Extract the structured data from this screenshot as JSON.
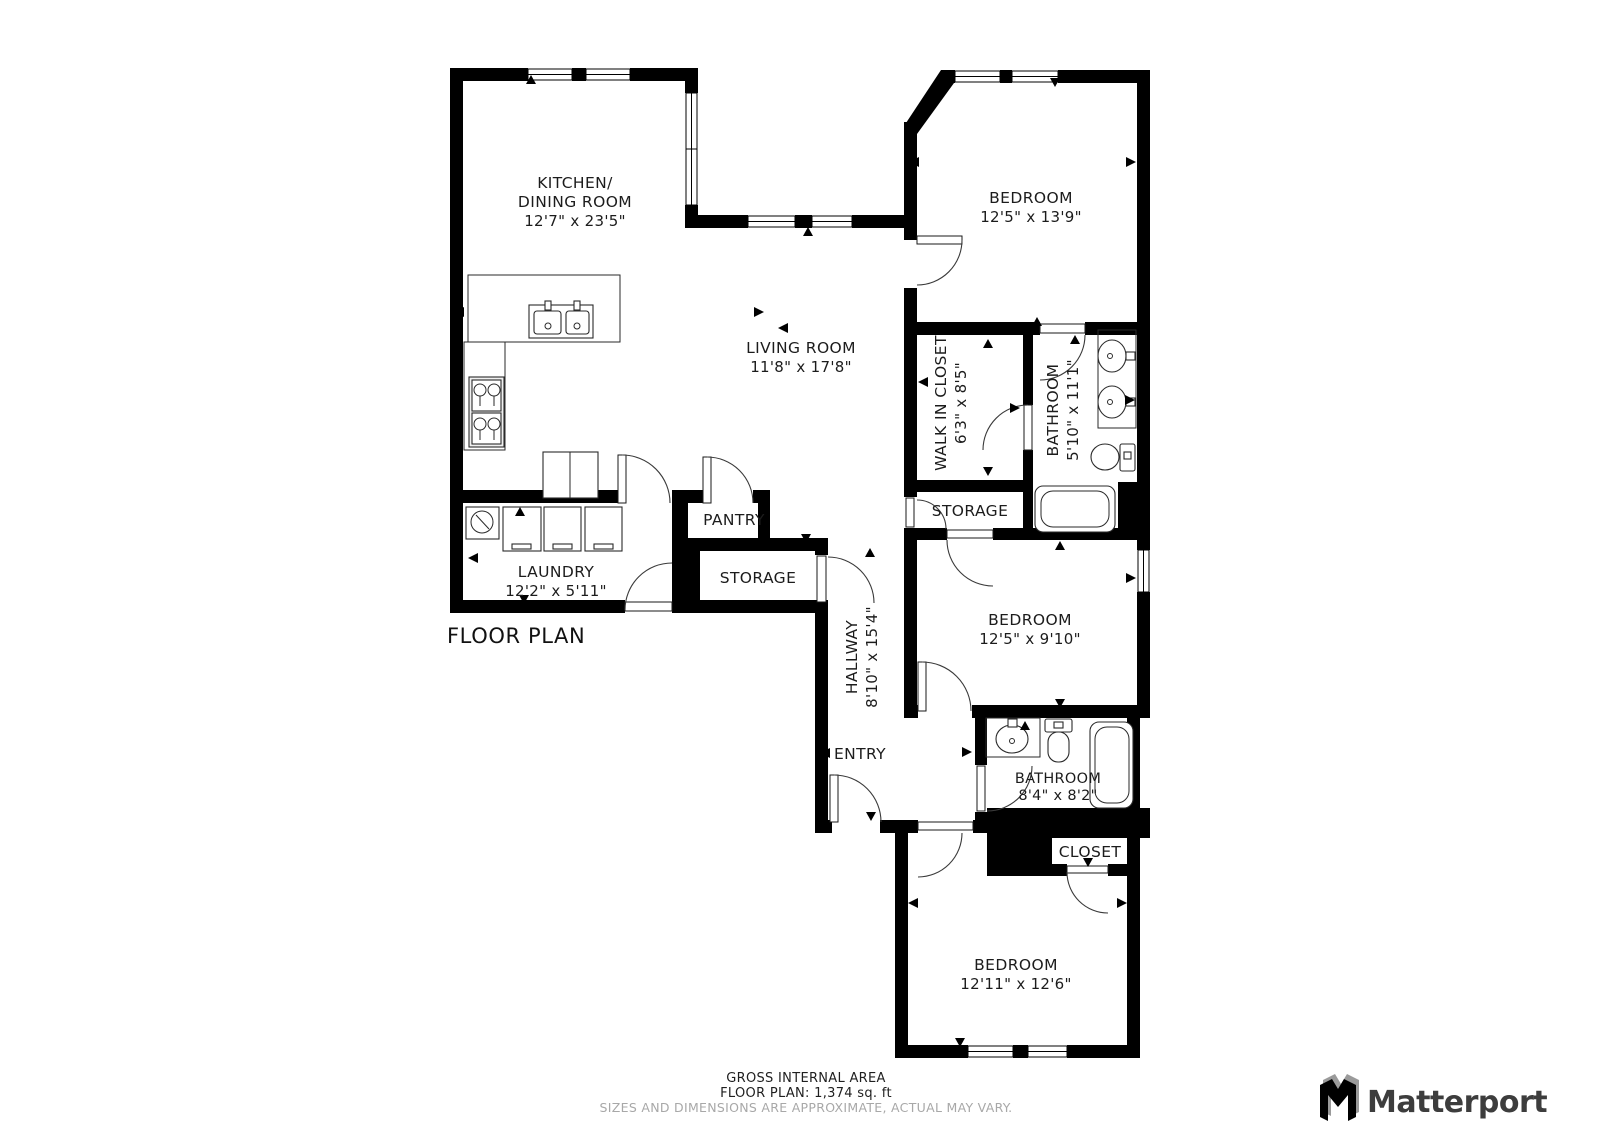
{
  "title": "FLOOR PLAN",
  "rooms": {
    "kitchen": {
      "line1": "KITCHEN/",
      "line2": "DINING ROOM",
      "dims": "12'7\" x 23'5\""
    },
    "living": {
      "name": "LIVING ROOM",
      "dims": "11'8\" x 17'8\""
    },
    "bedroom1": {
      "name": "BEDROOM",
      "dims": "12'5\" x 13'9\""
    },
    "walk_in_closet": {
      "name": "WALK IN CLOSET",
      "dims": "6'3\" x 8'5\""
    },
    "bathroom1": {
      "name": "BATHROOM",
      "dims": "5'10\" x 11'1\""
    },
    "storage_right": {
      "name": "STORAGE"
    },
    "pantry": {
      "name": "PANTRY"
    },
    "storage_left": {
      "name": "STORAGE"
    },
    "laundry": {
      "name": "LAUNDRY",
      "dims": "12'2\" x 5'11\""
    },
    "hallway": {
      "name": "HALLWAY",
      "dims": "8'10\" x 15'4\""
    },
    "entry": {
      "name": "ENTRY"
    },
    "bedroom2": {
      "name": "BEDROOM",
      "dims": "12'5\" x 9'10\""
    },
    "bathroom2": {
      "name": "BATHROOM",
      "dims": "8'4\" x 8'2\""
    },
    "closet": {
      "name": "CLOSET"
    },
    "bedroom3": {
      "name": "BEDROOM",
      "dims": "12'11\" x 12'6\""
    }
  },
  "footer": {
    "area_label": "GROSS INTERNAL AREA",
    "area_value": "FLOOR PLAN: 1,374 sq. ft",
    "disclaimer": "SIZES AND DIMENSIONS ARE APPROXIMATE, ACTUAL MAY VARY."
  },
  "brand": {
    "name": "Matterport"
  },
  "colors": {
    "wall": "#000000",
    "text": "#1c1c1c",
    "muted": "#a8a8a8",
    "logo": "#3d3d3d",
    "logo_shadow": "#9a9a9a"
  }
}
